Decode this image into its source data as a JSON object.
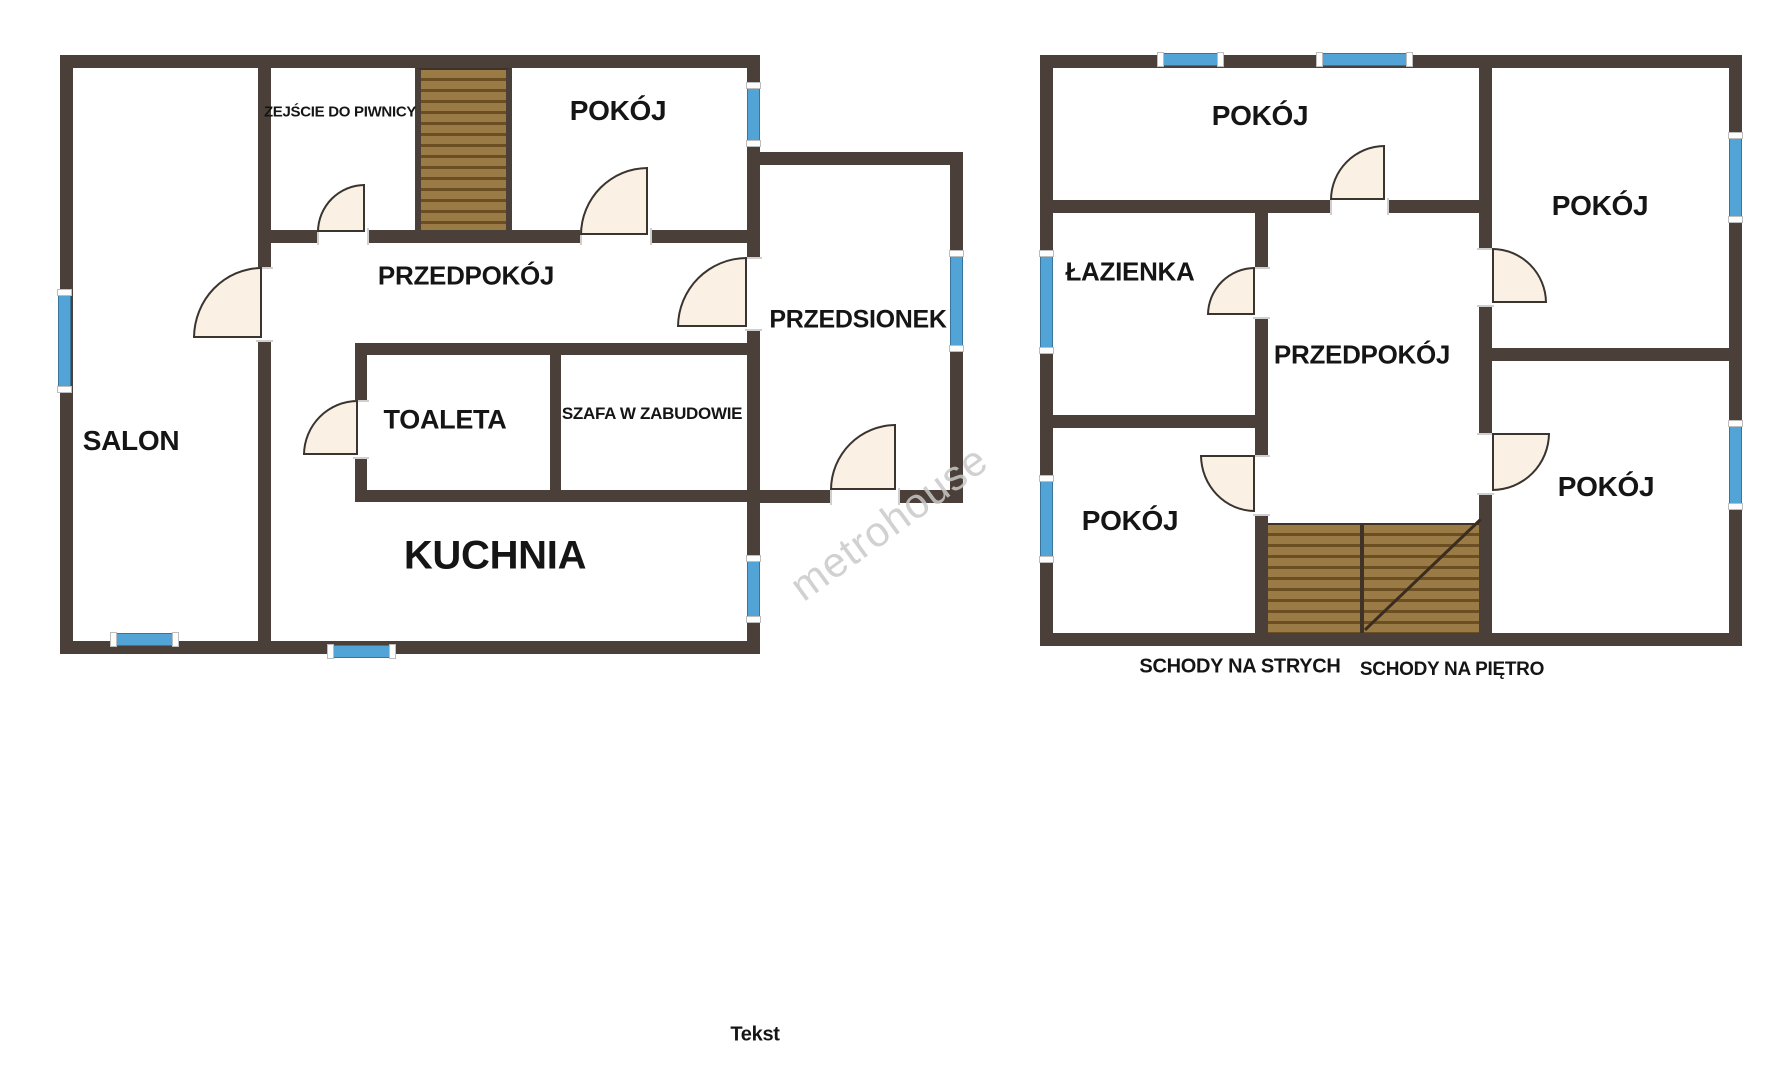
{
  "colors": {
    "background": "#ffffff",
    "wall": "#4a4039",
    "window_fill": "#52a3d6",
    "window_edge": "#39749c",
    "door_fill": "#faf1e4",
    "door_edge": "#3a342e",
    "stairs_fill": "#9a7a45",
    "stairs_line": "#6b4e22",
    "label": "#151515",
    "watermark": "#c9c9c9"
  },
  "watermark_text": "metrohouse",
  "footer_text": "Tekst",
  "ground_floor": {
    "rooms": {
      "salon": "SALON",
      "basement_exit": "ZEJŚCIE DO PIWNICY",
      "room": "POKÓJ",
      "hallway": "PRZEDPOKÓJ",
      "toilet": "TOALETA",
      "wardrobe": "SZAFA W ZABUDOWIE",
      "kitchen": "KUCHNIA",
      "vestibule": "PRZEDSIONEK"
    }
  },
  "upper_floor": {
    "rooms": {
      "room_top": "POKÓJ",
      "bathroom": "ŁAZIENKA",
      "hallway": "PRZEDPOKÓJ",
      "room_left": "POKÓJ",
      "room_right_top": "POKÓJ",
      "room_right_bottom": "POKÓJ"
    },
    "stairs_to_attic": "SCHODY NA STRYCH",
    "stairs_to_floor": "SCHODY NA PIĘTRO"
  }
}
